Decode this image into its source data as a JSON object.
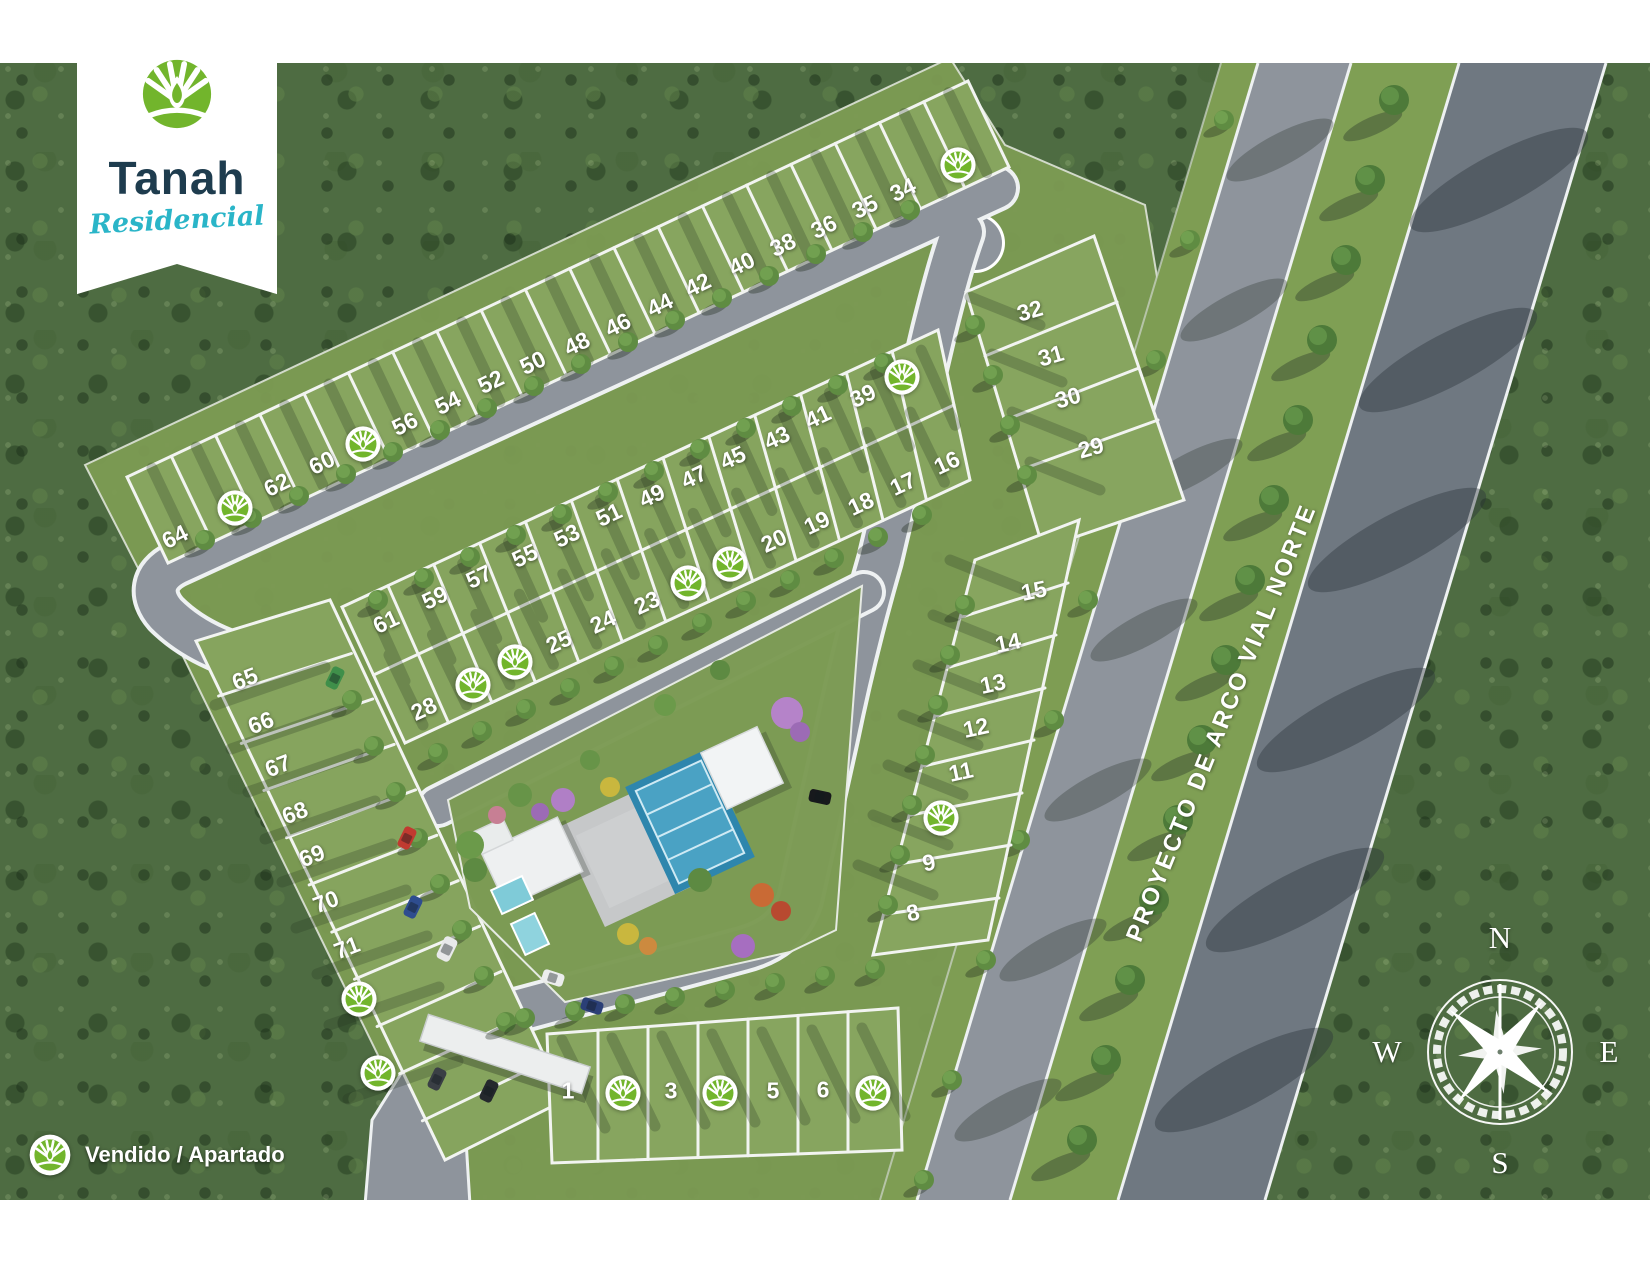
{
  "banner": {
    "brand": "Tanah",
    "subtitle": "Residencial"
  },
  "legend": {
    "label": "Vendido / Apartado"
  },
  "map": {
    "road_label": "PROYECTO DE ARCO VIAL NORTE",
    "compass": {
      "north": "N",
      "east": "E",
      "south": "S",
      "west": "W"
    },
    "lots": [
      {
        "n": "64",
        "x": 175,
        "y": 537,
        "r": -26
      },
      {
        "n": "62",
        "x": 277,
        "y": 485,
        "r": -26
      },
      {
        "n": "60",
        "x": 322,
        "y": 463,
        "r": -26
      },
      {
        "n": "56",
        "x": 405,
        "y": 424,
        "r": -26
      },
      {
        "n": "54",
        "x": 448,
        "y": 403,
        "r": -26
      },
      {
        "n": "52",
        "x": 491,
        "y": 382,
        "r": -26
      },
      {
        "n": "50",
        "x": 533,
        "y": 363,
        "r": -26
      },
      {
        "n": "48",
        "x": 577,
        "y": 344,
        "r": -26
      },
      {
        "n": "46",
        "x": 618,
        "y": 325,
        "r": -26
      },
      {
        "n": "44",
        "x": 660,
        "y": 305,
        "r": -26
      },
      {
        "n": "42",
        "x": 698,
        "y": 285,
        "r": -26
      },
      {
        "n": "40",
        "x": 742,
        "y": 264,
        "r": -26
      },
      {
        "n": "38",
        "x": 783,
        "y": 245,
        "r": -26
      },
      {
        "n": "36",
        "x": 824,
        "y": 227,
        "r": -26
      },
      {
        "n": "35",
        "x": 865,
        "y": 207,
        "r": -26
      },
      {
        "n": "34",
        "x": 903,
        "y": 190,
        "r": -26
      },
      {
        "n": "61",
        "x": 386,
        "y": 622,
        "r": -25
      },
      {
        "n": "59",
        "x": 435,
        "y": 598,
        "r": -25
      },
      {
        "n": "57",
        "x": 479,
        "y": 577,
        "r": -25
      },
      {
        "n": "55",
        "x": 525,
        "y": 556,
        "r": -25
      },
      {
        "n": "53",
        "x": 567,
        "y": 536,
        "r": -25
      },
      {
        "n": "51",
        "x": 609,
        "y": 515,
        "r": -25
      },
      {
        "n": "49",
        "x": 652,
        "y": 496,
        "r": -25
      },
      {
        "n": "47",
        "x": 694,
        "y": 477,
        "r": -25
      },
      {
        "n": "45",
        "x": 733,
        "y": 458,
        "r": -25
      },
      {
        "n": "43",
        "x": 777,
        "y": 438,
        "r": -25
      },
      {
        "n": "41",
        "x": 818,
        "y": 417,
        "r": -25
      },
      {
        "n": "39",
        "x": 863,
        "y": 396,
        "r": -25
      },
      {
        "n": "28",
        "x": 424,
        "y": 709,
        "r": -25
      },
      {
        "n": "25",
        "x": 559,
        "y": 642,
        "r": -25
      },
      {
        "n": "24",
        "x": 603,
        "y": 622,
        "r": -25
      },
      {
        "n": "23",
        "x": 647,
        "y": 603,
        "r": -25
      },
      {
        "n": "20",
        "x": 774,
        "y": 541,
        "r": -25
      },
      {
        "n": "19",
        "x": 817,
        "y": 523,
        "r": -25
      },
      {
        "n": "18",
        "x": 861,
        "y": 504,
        "r": -25
      },
      {
        "n": "17",
        "x": 903,
        "y": 484,
        "r": -25
      },
      {
        "n": "16",
        "x": 947,
        "y": 463,
        "r": -25
      },
      {
        "n": "32",
        "x": 1030,
        "y": 311,
        "r": -16
      },
      {
        "n": "31",
        "x": 1051,
        "y": 356,
        "r": -16
      },
      {
        "n": "30",
        "x": 1068,
        "y": 398,
        "r": -16
      },
      {
        "n": "29",
        "x": 1091,
        "y": 448,
        "r": -16
      },
      {
        "n": "15",
        "x": 1034,
        "y": 591,
        "r": -12
      },
      {
        "n": "14",
        "x": 1008,
        "y": 643,
        "r": -12
      },
      {
        "n": "13",
        "x": 993,
        "y": 684,
        "r": -12
      },
      {
        "n": "12",
        "x": 976,
        "y": 728,
        "r": -12
      },
      {
        "n": "11",
        "x": 961,
        "y": 772,
        "r": -12
      },
      {
        "n": "9",
        "x": 929,
        "y": 863,
        "r": -12
      },
      {
        "n": "8",
        "x": 913,
        "y": 913,
        "r": -12
      },
      {
        "n": "65",
        "x": 245,
        "y": 679,
        "r": -21
      },
      {
        "n": "66",
        "x": 261,
        "y": 723,
        "r": -21
      },
      {
        "n": "67",
        "x": 278,
        "y": 766,
        "r": -21
      },
      {
        "n": "68",
        "x": 295,
        "y": 813,
        "r": -21
      },
      {
        "n": "69",
        "x": 312,
        "y": 856,
        "r": -21
      },
      {
        "n": "70",
        "x": 326,
        "y": 902,
        "r": -21
      },
      {
        "n": "71",
        "x": 347,
        "y": 948,
        "r": -21
      },
      {
        "n": "1",
        "x": 568,
        "y": 1091,
        "r": 0
      },
      {
        "n": "3",
        "x": 671,
        "y": 1091,
        "r": 0
      },
      {
        "n": "5",
        "x": 773,
        "y": 1091,
        "r": 0
      },
      {
        "n": "6",
        "x": 823,
        "y": 1090,
        "r": 0
      }
    ],
    "sold_markers": [
      {
        "x": 235,
        "y": 508
      },
      {
        "x": 363,
        "y": 444
      },
      {
        "x": 958,
        "y": 165
      },
      {
        "x": 902,
        "y": 377
      },
      {
        "x": 473,
        "y": 685
      },
      {
        "x": 515,
        "y": 662
      },
      {
        "x": 688,
        "y": 583
      },
      {
        "x": 730,
        "y": 564
      },
      {
        "x": 941,
        "y": 818
      },
      {
        "x": 359,
        "y": 999
      },
      {
        "x": 378,
        "y": 1073
      },
      {
        "x": 623,
        "y": 1093
      },
      {
        "x": 720,
        "y": 1093
      },
      {
        "x": 873,
        "y": 1093
      }
    ]
  },
  "colors": {
    "brand_green": "#72b52c",
    "brand_navy": "#1e3c4e",
    "brand_teal": "#2ab5c8",
    "road_gray": "#8e949c",
    "grass": "#87a55f"
  }
}
